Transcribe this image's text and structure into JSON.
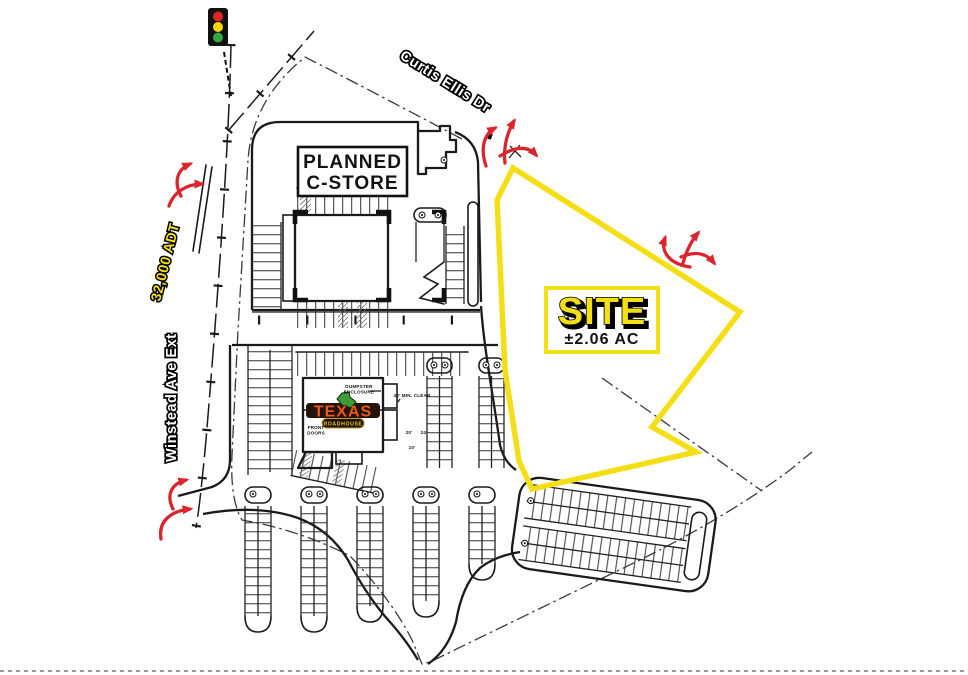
{
  "plan": {
    "cstore_label": {
      "line1": "PLANNED",
      "line2": "C-STORE"
    },
    "site_label": {
      "title": "SITE",
      "area": "±2.06 AC"
    },
    "streets": {
      "curtis_ellis": "Curtis Ellis Dr",
      "winstead": "Winstead Ave Ext",
      "traffic_count": "32,000 ADT"
    },
    "roadhouse": {
      "logo_name": "TEXAS",
      "logo_sub": "ROADHOUSE",
      "front_doors_line1": "FRONT",
      "front_doors_line2": "DOORS",
      "dumpster_line1": "DUMPSTER",
      "dumpster_line2": "ENCLOSURE",
      "clear_dim": "40' MIN. CLEAR",
      "dim_20": "20'",
      "dim_24": "24'",
      "dim_10": "10'"
    },
    "icons": {
      "traffic_light": "traffic-light"
    },
    "colors": {
      "site_outline": "#f4df17",
      "arrow_red": "#d9262c",
      "adt_yellow": "#f4df17",
      "logo_orange": "#e8591c",
      "logo_green": "#3f9b35",
      "signal_red": "#e02428",
      "signal_amber": "#ffd400",
      "signal_green": "#35a843",
      "line_black": "#1a1a1a"
    }
  }
}
